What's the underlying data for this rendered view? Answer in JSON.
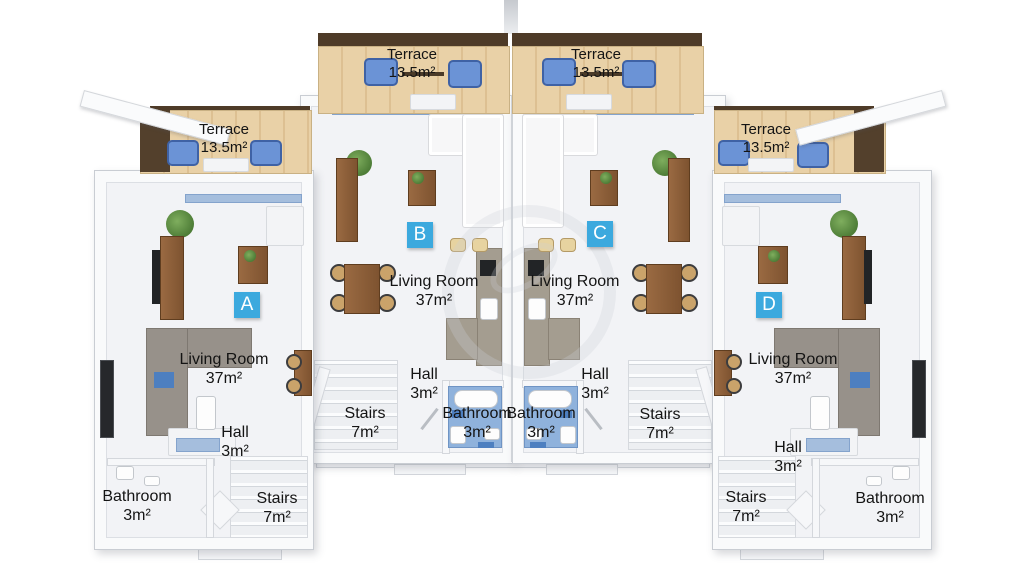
{
  "units": [
    {
      "badge": "A",
      "terrace": {
        "name": "Terrace",
        "area": "13.5m²"
      },
      "living_room": {
        "name": "Living Room",
        "area": "37m²"
      },
      "hall": {
        "name": "Hall",
        "area": "3m²"
      },
      "stairs": {
        "name": "Stairs",
        "area": "7m²"
      },
      "bathroom": {
        "name": "Bathroom",
        "area": "3m²"
      }
    },
    {
      "badge": "B",
      "terrace": {
        "name": "Terrace",
        "area": "13.5m²"
      },
      "living_room": {
        "name": "Living Room",
        "area": "37m²"
      },
      "hall": {
        "name": "Hall",
        "area": "3m²"
      },
      "stairs": {
        "name": "Stairs",
        "area": "7m²"
      },
      "bathroom": {
        "name": "Bathroom",
        "area": "3m²"
      }
    },
    {
      "badge": "C",
      "terrace": {
        "name": "Terrace",
        "area": "13.5m²"
      },
      "living_room": {
        "name": "Living Room",
        "area": "37m²"
      },
      "hall": {
        "name": "Hall",
        "area": "3m²"
      },
      "stairs": {
        "name": "Stairs",
        "area": "7m²"
      },
      "bathroom": {
        "name": "Bathroom",
        "area": "3m²"
      }
    },
    {
      "badge": "D",
      "terrace": {
        "name": "Terrace",
        "area": "13.5m²"
      },
      "living_room": {
        "name": "Living Room",
        "area": "37m²"
      },
      "hall": {
        "name": "Hall",
        "area": "3m²"
      },
      "stairs": {
        "name": "Stairs",
        "area": "7m²"
      },
      "bathroom": {
        "name": "Bathroom",
        "area": "3m²"
      }
    }
  ],
  "colors": {
    "badge_blue": "#3ca9de",
    "terrace_wood": "#e9d1a7",
    "terrace_rail": "#4e3b28",
    "armchair_blue": "#6b93d6",
    "bathroom_floor_blue": "#8fb2dc",
    "kitchen_counter": "#a49d90",
    "wood_furniture": "#8a5a36",
    "wall_white": "#f9fafb",
    "floor_gray": "#f2f3f6"
  }
}
